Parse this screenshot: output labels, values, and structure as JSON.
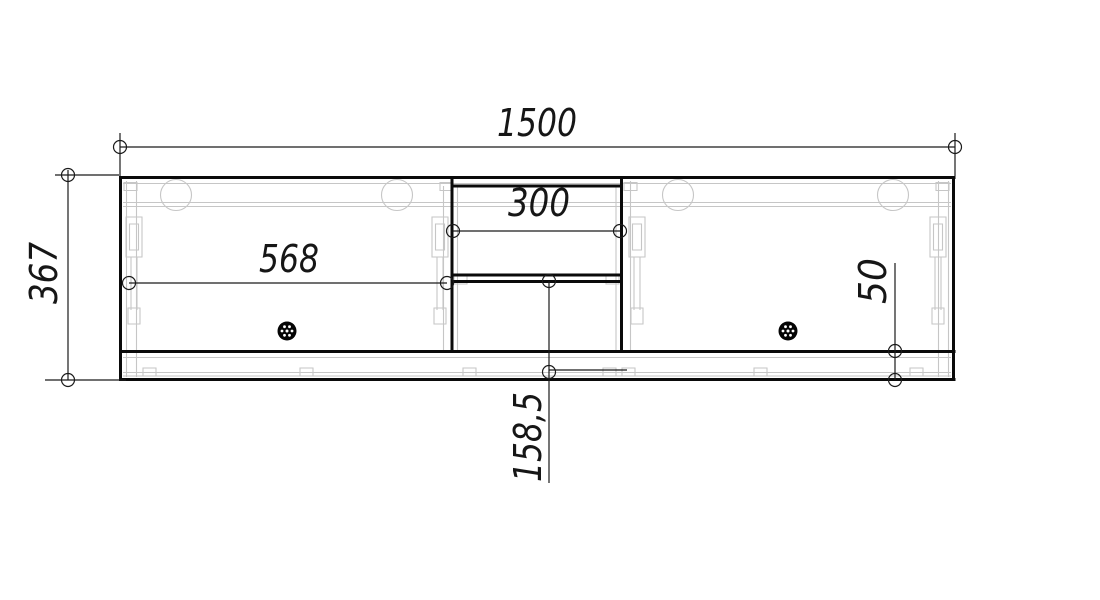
{
  "drawing": {
    "labels": {
      "total_width": "1500",
      "total_height": "367",
      "left_door_width": "568",
      "center_opening_width": "300",
      "bottom_offset": "50",
      "lower_section_height": "158,5"
    },
    "colors": {
      "outline": "#0a0a0a",
      "dimension_line": "#1a1a1a",
      "hidden_line": "#c6c6c6",
      "background": "#ffffff"
    }
  }
}
